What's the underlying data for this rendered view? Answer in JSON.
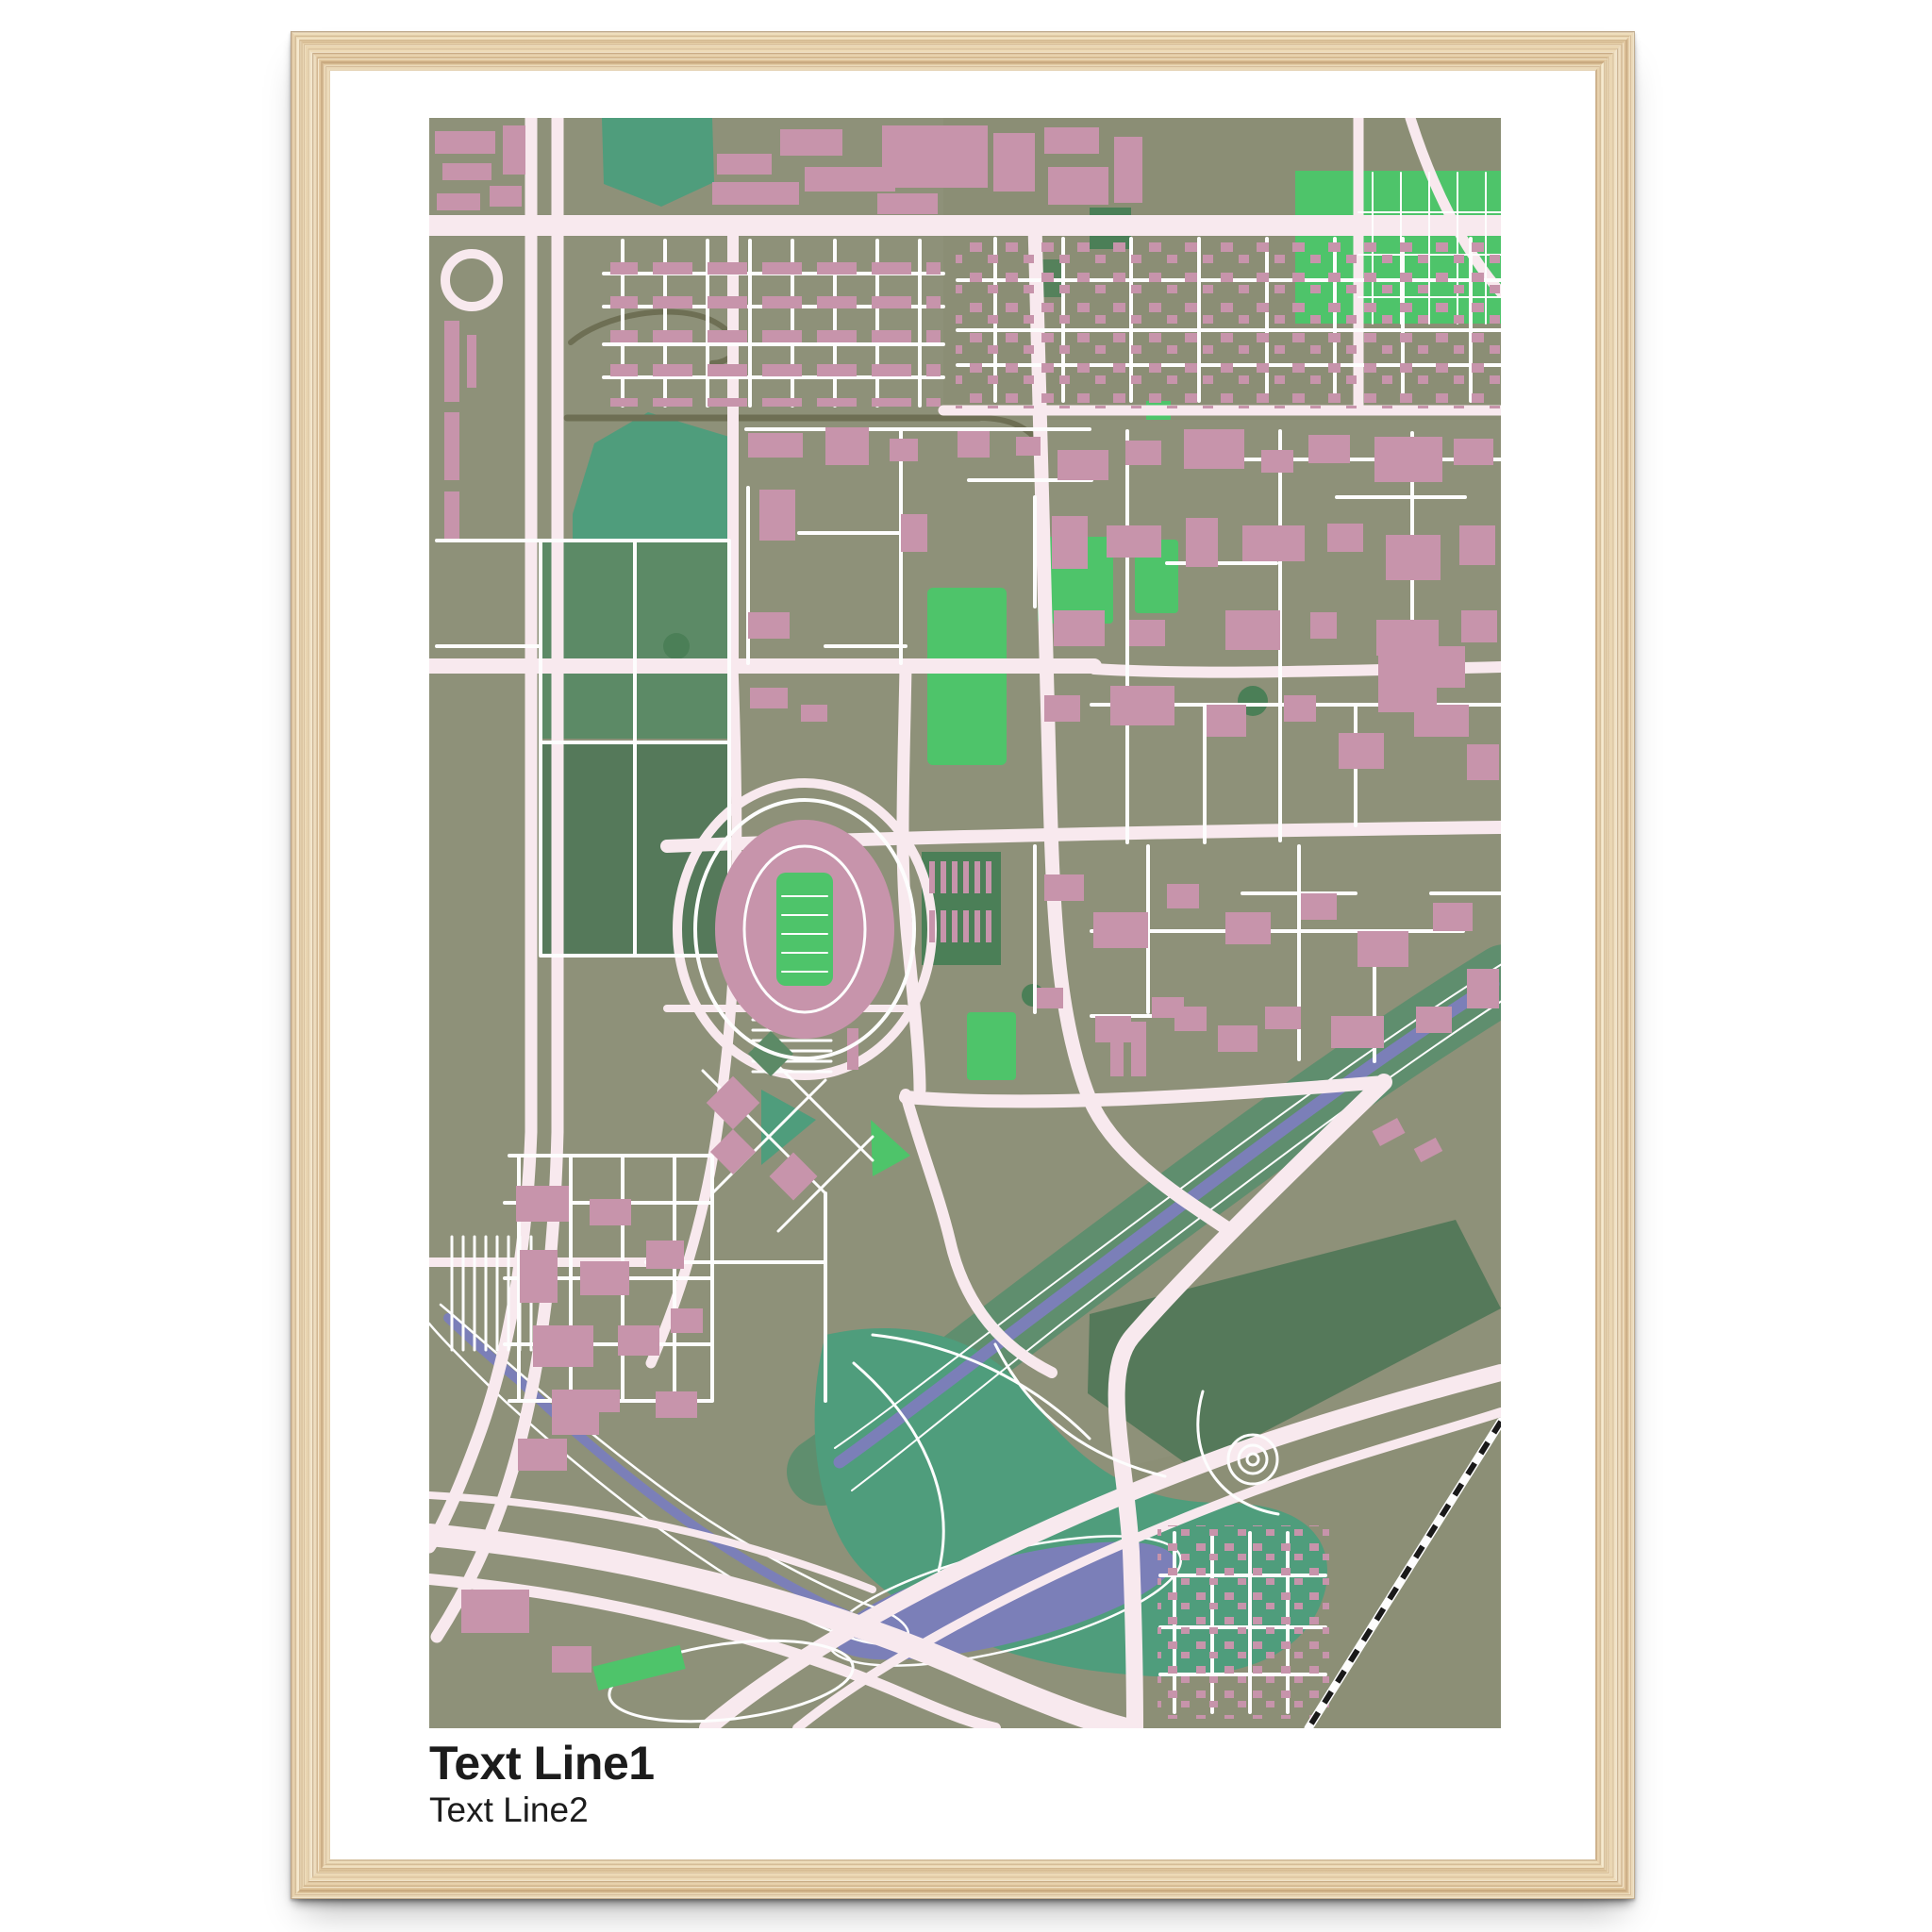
{
  "poster": {
    "line1": "Text Line1",
    "line2": "Text Line2"
  },
  "palette": {
    "canvas_bg": "#ffffff",
    "frame_wood_base": "#e9d2ab",
    "frame_wood_dark": "#c9a478",
    "frame_wood_light": "#f6ecd6",
    "mat_white": "#ffffff",
    "map_bg": "#8e9179",
    "map_bg_dark": "#898c72",
    "road_major": "#f8e9ee",
    "road_minor": "#fdfdfd",
    "road_dark": "#6e6f54",
    "building_pink": "#c794ab",
    "building_pink_light": "#d4a8bc",
    "green_bright": "#4ec46a",
    "green_teal": "#4f9d7c",
    "green_sage": "#5c8a66",
    "green_sage_dark": "#55795a",
    "green_dark": "#4b7f57",
    "river_corridor": "#5f8e6e",
    "water_purple": "#7b7fb8",
    "railway_black": "#191919",
    "text_color": "#1c1c1c"
  }
}
